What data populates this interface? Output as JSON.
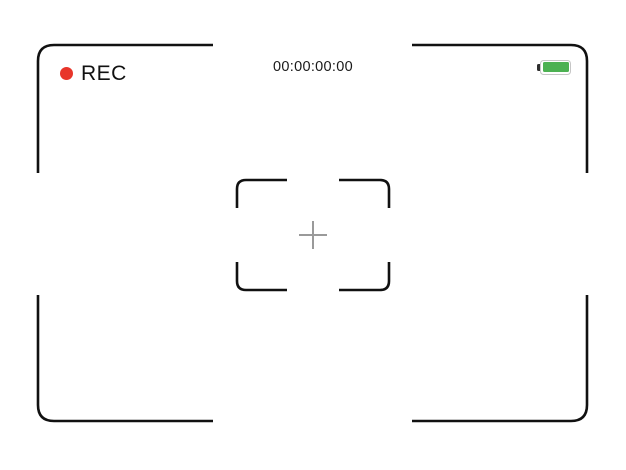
{
  "hud": {
    "rec": {
      "label": "REC"
    },
    "timecode": "00:00:00:00",
    "battery": {
      "level": "full",
      "fill_ratio": 1
    }
  },
  "icons": {
    "rec_dot": {
      "name": "rec-dot-icon",
      "shape": "circle",
      "color": "#E8352A"
    },
    "battery": {
      "name": "battery-icon",
      "fill_color": "#4CB152",
      "border_color": "#C6C6C6",
      "nub_color": "#2F2F2F",
      "nub_side": "left"
    },
    "crosshair": {
      "name": "crosshair-icon",
      "glyph": "+",
      "color": "#9A9A9A"
    }
  },
  "colors": {
    "background": "#FFFFFF",
    "frame": "#111111",
    "focus_brackets": "#111111",
    "timecode_text": "#1A1A1A",
    "rec_text": "#111111"
  }
}
